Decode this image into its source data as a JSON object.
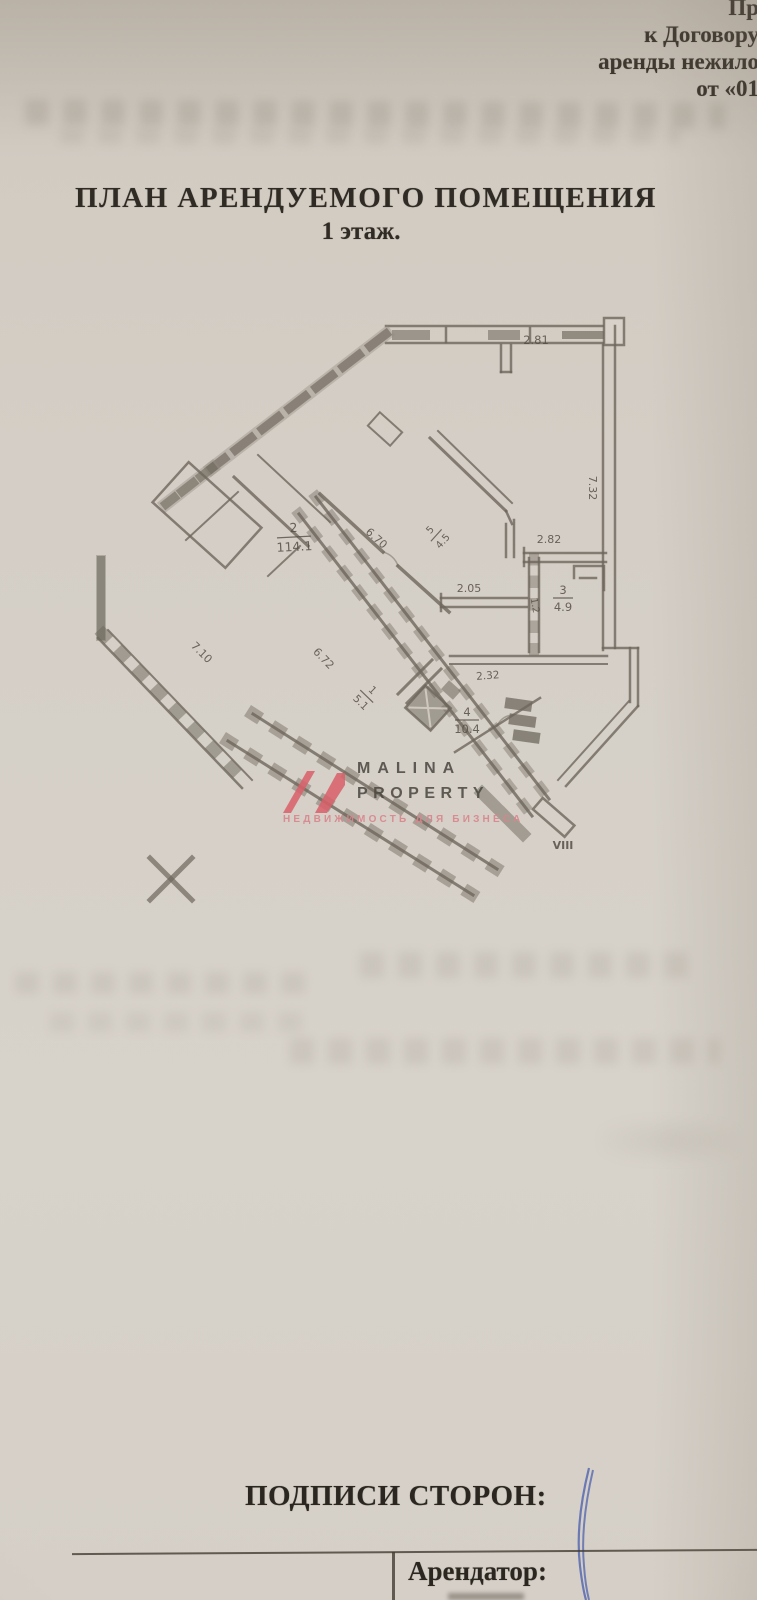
{
  "header": {
    "lines": [
      "Пр",
      "к Договору",
      "аренды нежило",
      "от «01"
    ]
  },
  "title": {
    "line1": "ПЛАН АРЕНДУЕМОГО ПОМЕЩЕНИЯ",
    "line2": "1 этаж."
  },
  "plan": {
    "dim_top": "2.81",
    "dim_right": "7.32",
    "dim_282": "2.82",
    "dim_205": "2.05",
    "dim_232": "2.32",
    "dim_670": "6.70",
    "dim_672": "6.72",
    "dim_710": "7.10",
    "room2_num": "2",
    "room2_area": "114.1",
    "room3_num": "3",
    "room3_area": "4.9",
    "room4_num": "4",
    "room4_area": "10.4",
    "room1_num": "1",
    "room1_area": "5.1",
    "room5_num": "5",
    "room5_area": "4.5",
    "small_label": "1.2",
    "stairs_label": "VIII"
  },
  "watermark": {
    "brand_top": "MALINA",
    "brand_bottom": "PROPERTY",
    "tagline": "НЕДВИЖИМОСТЬ ДЛЯ БИЗНЕСА"
  },
  "signatures": {
    "heading": "ПОДПИСИ СТОРОН:",
    "tenant_label": "Арендатор:"
  },
  "colors": {
    "paper": "#d5cfc7",
    "plan_line": "#6e675c",
    "brand_accent": "#d95f68",
    "tagline_pink": "#d9858c",
    "pen_ink": "#4f63ae"
  }
}
